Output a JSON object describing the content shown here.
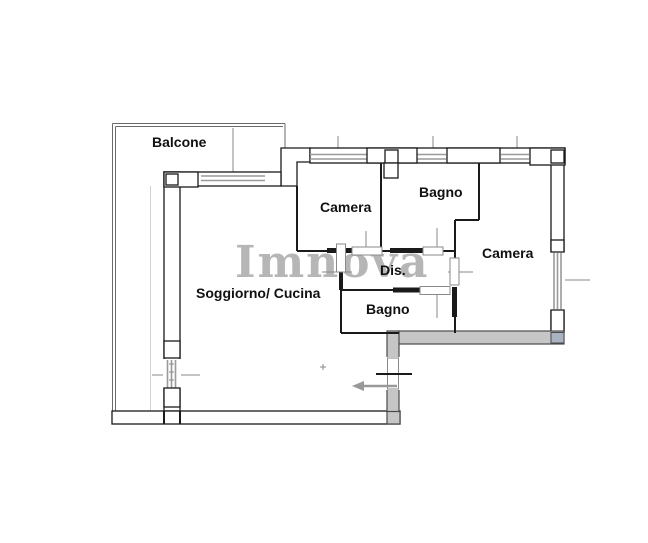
{
  "watermark": "Imnova",
  "rooms": {
    "balcone": {
      "label": "Balcone"
    },
    "camera_top": {
      "label": "Camera"
    },
    "bagno_top": {
      "label": "Bagno"
    },
    "camera_right": {
      "label": "Camera"
    },
    "dis": {
      "label": "Dis."
    },
    "bagno_bottom": {
      "label": "Bagno"
    },
    "soggiorno": {
      "label": "Soggiorno/ Cucina"
    }
  },
  "colors": {
    "wall": "#1a1a1a",
    "balcony": "#6a6a6a",
    "window": "#9a9a9a",
    "gray-wall": "#c6c6c6",
    "gray-edge": "#4a4a4a",
    "watermark": "#b6b6b6",
    "arrow": "#999999",
    "tick": "#8a8a8a",
    "label": "#111111"
  }
}
